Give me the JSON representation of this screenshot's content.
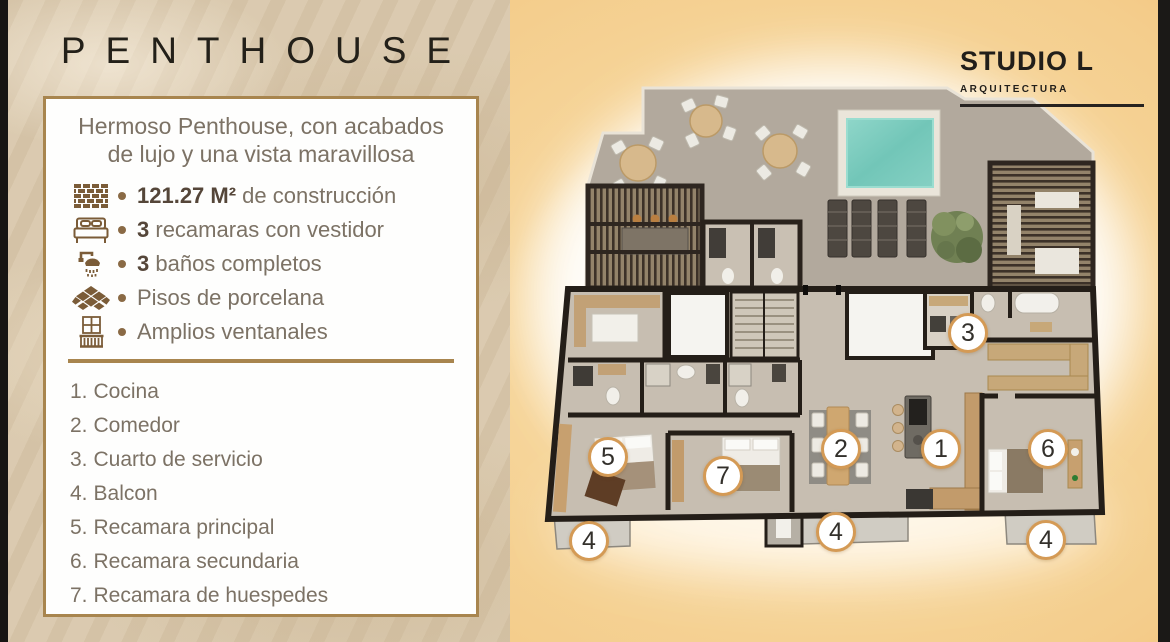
{
  "left_panel": {
    "title": "PENTHOUSE",
    "description_line1": "Hermoso Penthouse, con acabados",
    "description_line2": "de lujo y una vista maravillosa",
    "features": [
      {
        "icon": "brick-wall-icon",
        "bold": "121.27 M²",
        "text": " de construcción"
      },
      {
        "icon": "bed-icon",
        "bold": "3",
        "text": " recamaras con vestidor"
      },
      {
        "icon": "shower-icon",
        "bold": "3",
        "text": " baños completos"
      },
      {
        "icon": "floor-tile-icon",
        "bold": "",
        "text": "Pisos de porcelana"
      },
      {
        "icon": "balcony-window-icon",
        "bold": "",
        "text": "Amplios ventanales"
      }
    ],
    "legend": [
      {
        "num": "1.",
        "label": "Cocina"
      },
      {
        "num": "2.",
        "label": "Comedor"
      },
      {
        "num": "3.",
        "label": "Cuarto de servicio"
      },
      {
        "num": "4.",
        "label": "Balcon"
      },
      {
        "num": "5.",
        "label": "Recamara principal"
      },
      {
        "num": "6.",
        "label": "Recamara secundaria"
      },
      {
        "num": "7.",
        "label": "Recamara de huespedes"
      }
    ]
  },
  "right_panel": {
    "logo_title": "STUDIO L",
    "logo_subtitle": "ARQUITECTURA",
    "plan_markers": [
      {
        "label": "3",
        "x": 458,
        "y": 333
      },
      {
        "label": "5",
        "x": 98,
        "y": 457
      },
      {
        "label": "7",
        "x": 213,
        "y": 476
      },
      {
        "label": "2",
        "x": 331,
        "y": 449
      },
      {
        "label": "1",
        "x": 431,
        "y": 449
      },
      {
        "label": "6",
        "x": 538,
        "y": 449
      },
      {
        "label": "4",
        "x": 79,
        "y": 541
      },
      {
        "label": "4",
        "x": 326,
        "y": 532
      },
      {
        "label": "4",
        "x": 536,
        "y": 540
      }
    ]
  },
  "colors": {
    "accent_gold": "#a8854e",
    "text_brown": "#7c7265",
    "icon_brown": "#7b5c38",
    "pool_turquoise": "#76c9bb",
    "background_orange": "#edae5c",
    "sand": "#d8c7ac",
    "wall_dark": "#241e18"
  }
}
